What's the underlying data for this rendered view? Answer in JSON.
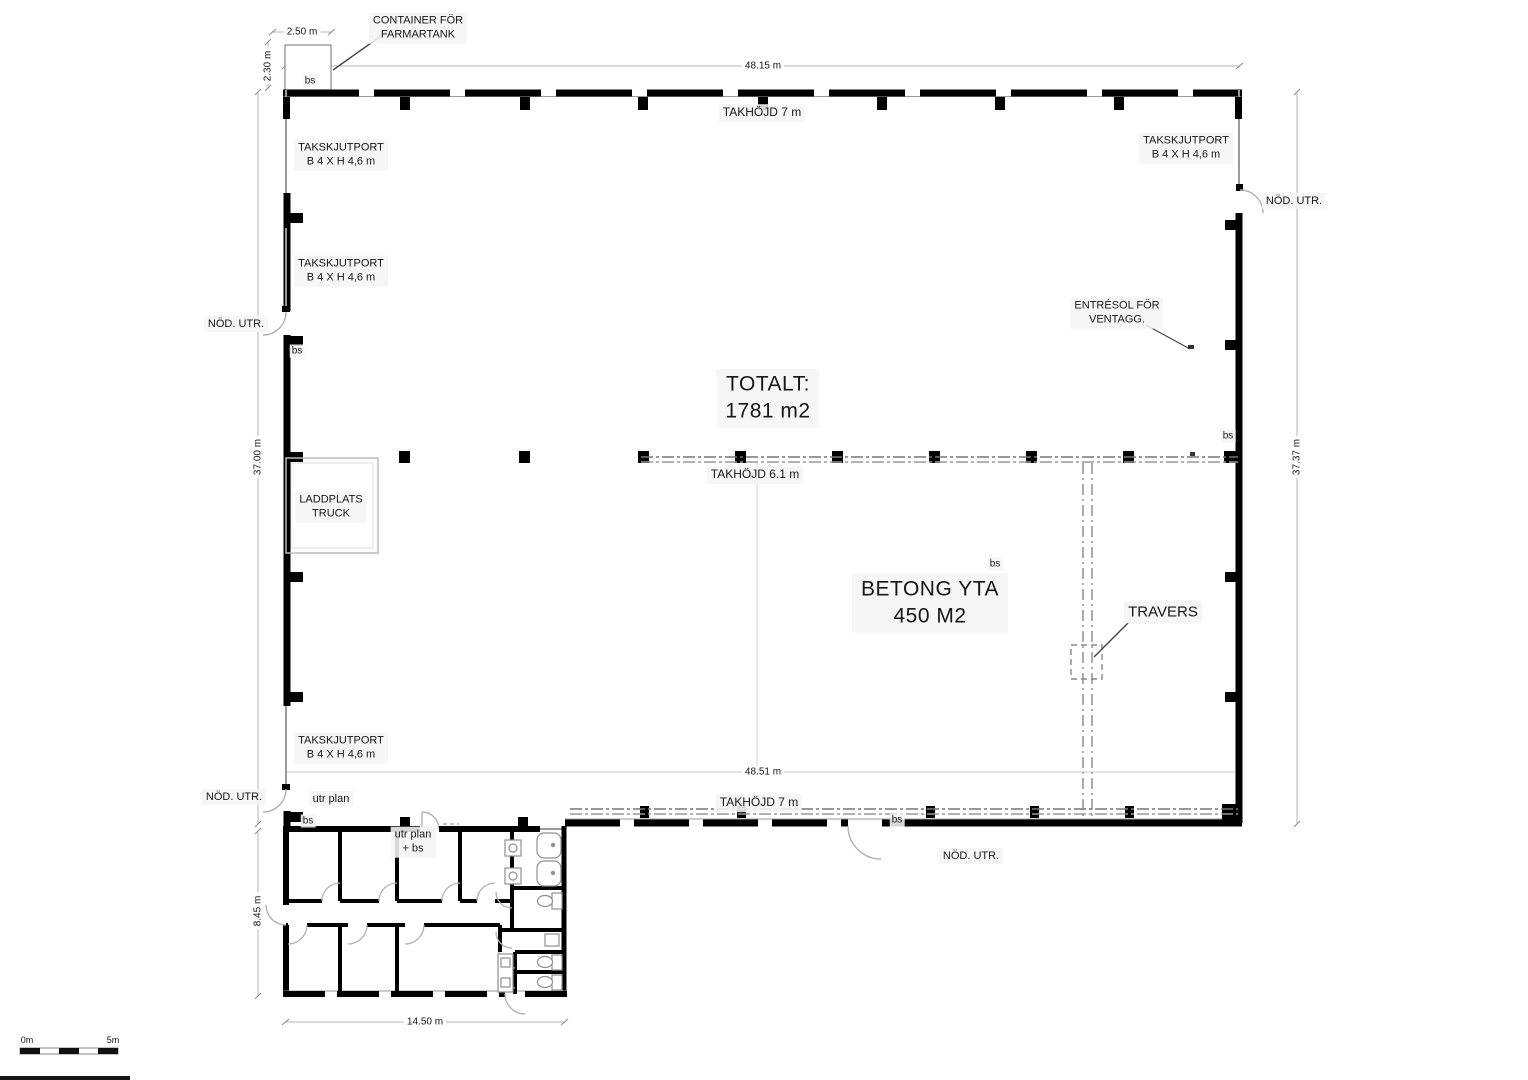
{
  "labels": {
    "container": {
      "l1": "CONTAINER FÖR",
      "l2": "FARMARTANK"
    },
    "takskjutport": {
      "l1": "TAKSKJUTPORT",
      "l2": "B 4 X  H 4,6 m"
    },
    "nod_utr": "NÖD. UTR.",
    "entresol": {
      "l1": "ENTRÉSOL FÖR",
      "l2": "VENTAGG."
    },
    "totalt": {
      "l1": "TOTALT:",
      "l2": "1781 m2"
    },
    "takhojd_7": "TAKHÖJD 7 m",
    "takhojd_61": "TAKHÖJD 6.1 m",
    "laddplats": {
      "l1": "LADDPLATS",
      "l2": "TRUCK"
    },
    "betong": {
      "l1": "BETONG YTA",
      "l2": "450 M2"
    },
    "travers": "TRAVERS",
    "bs": "bs",
    "utr_plan": "utr plan",
    "utr_plan_bs": {
      "l1": "utr plan",
      "l2": "+ bs"
    }
  },
  "dimensions": {
    "top_width": "48.15 m",
    "bottom_width": "48.51 m",
    "left_height": "37.00 m",
    "right_height": "37.37 m",
    "container_width": "2.50 m",
    "container_height": "2.30 m",
    "office_height": "8.45 m",
    "office_width": "14.50 m"
  },
  "scale_bar": {
    "start": "0m",
    "end": "5m"
  },
  "colors": {
    "wall": "#000000",
    "thin_wall": "#9a9a9a",
    "dimension_line": "#b5b5b5",
    "dash_grid": "#777777",
    "label_bg": "#f5f5f5"
  }
}
